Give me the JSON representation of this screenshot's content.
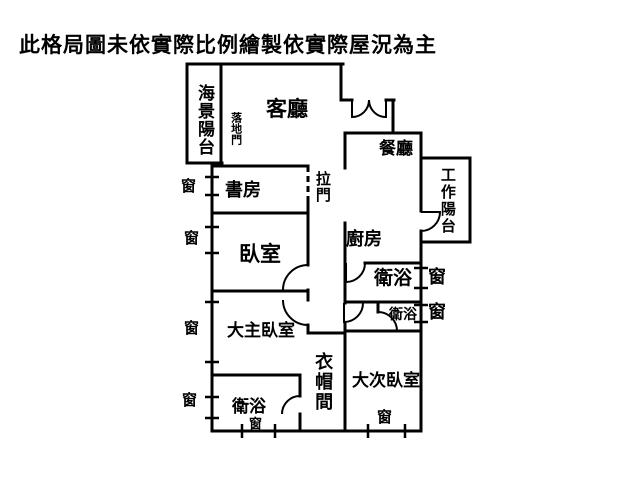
{
  "title": "此格局圖未依實際比例繪製依實際屋況為主",
  "rooms": {
    "living_room": "客廳",
    "dining_room": "餐廳",
    "study": "書房",
    "bedroom": "臥室",
    "kitchen": "廚房",
    "master_bedroom": "大主臥室",
    "second_bedroom": "大次臥室",
    "walk_in_closet": "衣帽間",
    "bathroom_main": "衛浴",
    "bathroom_small": "衛浴",
    "bathroom_master": "衛浴",
    "sea_view_balcony": "海景陽台",
    "work_balcony": "工作陽台"
  },
  "doors": {
    "french_door": "落地門",
    "sliding_door": "拉門"
  },
  "window_label": "窗",
  "colors": {
    "wall": "#000000",
    "background": "#ffffff"
  }
}
